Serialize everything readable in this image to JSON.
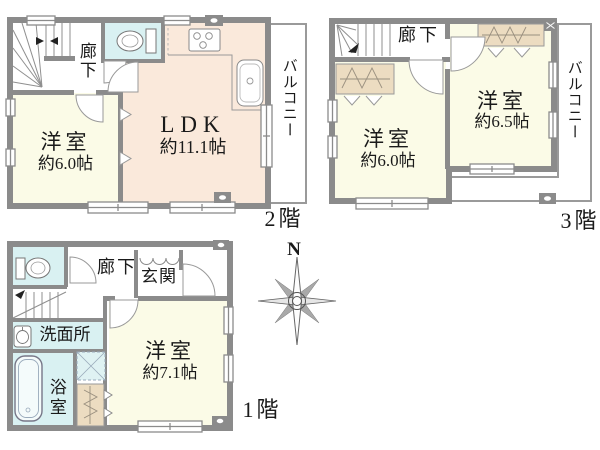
{
  "floors": {
    "f1": {
      "label": "1階",
      "corridor": "廊下",
      "entrance": "玄関",
      "washroom": "洗面所",
      "bathroom": "浴室",
      "room1": {
        "name": "洋室",
        "size": "約7.1帖"
      }
    },
    "f2": {
      "label": "2階",
      "corridor": "廊下",
      "balcony": "バルコニー",
      "ldk": {
        "name": "LDK",
        "size": "約11.1帖"
      },
      "room1": {
        "name": "洋室",
        "size": "約6.0帖"
      }
    },
    "f3": {
      "label": "3階",
      "corridor": "廊下",
      "balcony": "バルコニー",
      "room1": {
        "name": "洋室",
        "size": "約6.0帖"
      },
      "room2": {
        "name": "洋室",
        "size": "約6.5帖"
      }
    }
  },
  "compass": {
    "north": "N"
  },
  "colors": {
    "wall": "#8b8b8b",
    "ldk_fill": "#fae9db",
    "room_fill": "#fbfbe7",
    "wet_area_fill": "#d9f1f2",
    "closet_fill": "#ecdcc1",
    "thin_line": "#999999",
    "text": "#1a1a1a"
  },
  "icons": {
    "toilet": "toilet-fixture",
    "bathtub": "bathtub",
    "washbasin": "washbasin",
    "stove": "gas-stove-3-burner",
    "kitchen_sink": "kitchen-sink",
    "stairs": "staircase",
    "compass": "8-point-compass-rose",
    "meter": "meter-box"
  }
}
